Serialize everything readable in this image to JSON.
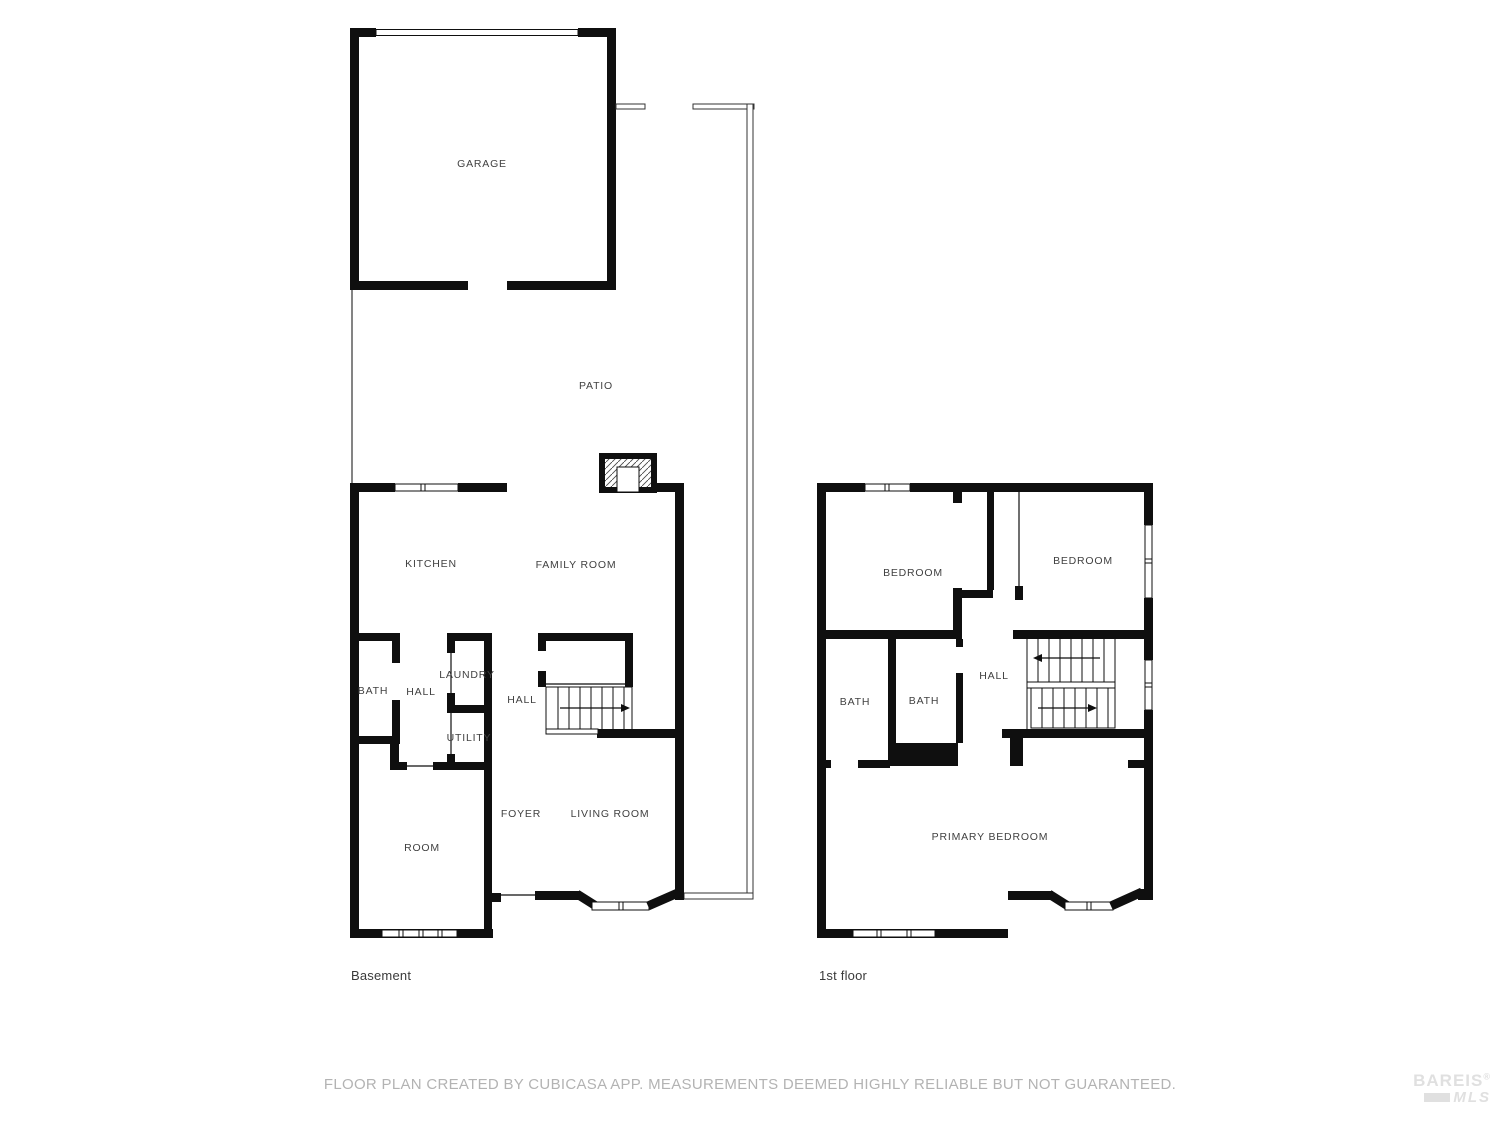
{
  "page": {
    "wall_color": "#0f0f0f",
    "room_label_color": "#414141",
    "floor_label_color": "#3a3a3a",
    "disclaimer_color": "#b3b3b3",
    "watermark_color": "#e0e0e0",
    "disclaimer": "FLOOR PLAN CREATED BY CUBICASA APP. MEASUREMENTS DEEMED HIGHLY RELIABLE BUT NOT GUARANTEED."
  },
  "basement": {
    "floor_label": "Basement",
    "rooms": {
      "garage": "GARAGE",
      "patio": "PATIO",
      "kitchen": "KITCHEN",
      "family_room": "FAMILY ROOM",
      "bath": "BATH",
      "hall_upper": "HALL",
      "laundry": "LAUNDRY",
      "utility": "UTILITY",
      "hall_stairs": "HALL",
      "foyer": "FOYER",
      "living_room": "LIVING ROOM",
      "room": "ROOM"
    }
  },
  "first_floor": {
    "floor_label": "1st floor",
    "rooms": {
      "bedroom_left": "BEDROOM",
      "bedroom_right": "BEDROOM",
      "bath_left": "BATH",
      "bath_right": "BATH",
      "hall": "HALL",
      "primary_bedroom": "PRIMARY BEDROOM"
    }
  },
  "watermark": {
    "brand": "BAREIS",
    "registered_mark": "®",
    "sub_brand": "MLS"
  }
}
